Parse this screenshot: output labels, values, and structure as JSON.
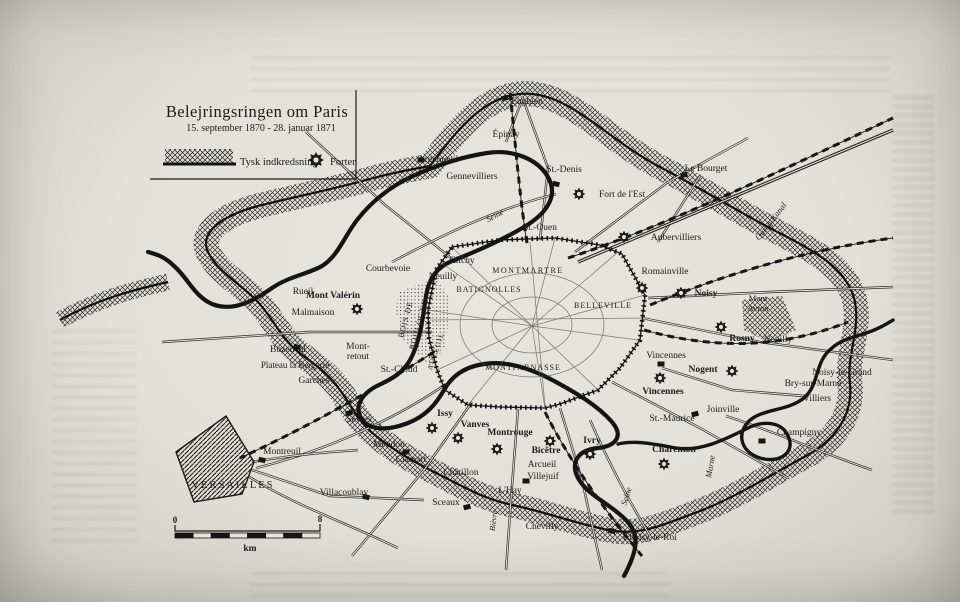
{
  "map": {
    "title": "Belejringsringen om Paris",
    "subtitle": "15. september 1870 - 28. januar 1871",
    "legend": {
      "band_label": "Tysk indkredsning",
      "fort_label": "Forter"
    },
    "scale": {
      "start": "0",
      "end": "8",
      "unit": "km"
    },
    "colors": {
      "ink": "#1b1b1b",
      "paper": "#e6e3dc",
      "page_edge": "#b7b4af"
    },
    "labels": [
      {
        "t": "Enghien",
        "x": 527,
        "y": 104
      },
      {
        "t": "Épinay",
        "x": 506,
        "y": 137
      },
      {
        "t": "Argenteuil",
        "x": 438,
        "y": 162
      },
      {
        "t": "Gennevilliers",
        "x": 472,
        "y": 179
      },
      {
        "t": "St.-Denis",
        "x": 564,
        "y": 172
      },
      {
        "t": "Le Bourget",
        "x": 706,
        "y": 171
      },
      {
        "t": "Fort de l'Est",
        "x": 622,
        "y": 197
      },
      {
        "t": "St.-Ouen",
        "x": 540,
        "y": 230
      },
      {
        "t": "Seine",
        "x": 496,
        "y": 218,
        "i": 1,
        "r": -28,
        "fs": 8.5
      },
      {
        "t": "Aubervilliers",
        "x": 676,
        "y": 240
      },
      {
        "t": "Courbevoie",
        "x": 388,
        "y": 271
      },
      {
        "t": "Clichy",
        "x": 462,
        "y": 263
      },
      {
        "t": "Neuilly",
        "x": 443,
        "y": 279
      },
      {
        "t": "MONTMARTRE",
        "x": 528,
        "y": 273,
        "fs": 8,
        "ls": 1.5
      },
      {
        "t": "BATIGNOLLES",
        "x": 489,
        "y": 292,
        "fs": 8,
        "ls": 1
      },
      {
        "t": "Romainville",
        "x": 665,
        "y": 274
      },
      {
        "t": "Noisy",
        "x": 706,
        "y": 296,
        "b": 1
      },
      {
        "t": "Mont",
        "x": 758,
        "y": 301,
        "fs": 8.5
      },
      {
        "t": "Avron",
        "x": 758,
        "y": 311,
        "fs": 8.5
      },
      {
        "t": "BELLEVILLE",
        "x": 603,
        "y": 308,
        "fs": 8,
        "ls": 1
      },
      {
        "t": "Rueil",
        "x": 303,
        "y": 294
      },
      {
        "t": "Mont Valérin",
        "x": 333,
        "y": 298,
        "b": 1
      },
      {
        "t": "Malmaison",
        "x": 313,
        "y": 315
      },
      {
        "t": "Rosny",
        "x": 742,
        "y": 341,
        "b": 1
      },
      {
        "t": "Neuilly",
        "x": 778,
        "y": 342
      },
      {
        "t": "Buzenval",
        "x": 288,
        "y": 352
      },
      {
        "t": "Mont-",
        "x": 358,
        "y": 349
      },
      {
        "t": "retout",
        "x": 358,
        "y": 359
      },
      {
        "t": "Plateau la Bergerie",
        "x": 295,
        "y": 368,
        "fs": 9
      },
      {
        "t": "Garches",
        "x": 314,
        "y": 383
      },
      {
        "t": "St.-Cloud",
        "x": 399,
        "y": 372
      },
      {
        "t": "AUTEUIL",
        "x": 438,
        "y": 352,
        "fs": 7.5,
        "r": -72,
        "ls": 1
      },
      {
        "t": "BOIS DE",
        "x": 408,
        "y": 320,
        "fs": 8,
        "r": -75,
        "ls": 1
      },
      {
        "t": "BOULOGNE",
        "x": 421,
        "y": 325,
        "fs": 8,
        "r": -75,
        "ls": 1
      },
      {
        "t": "MONTPARNASSE",
        "x": 523,
        "y": 370,
        "fs": 8,
        "ls": 1
      },
      {
        "t": "Vincennes",
        "x": 666,
        "y": 358
      },
      {
        "t": "Nogent",
        "x": 703,
        "y": 372,
        "b": 1
      },
      {
        "t": "Vincennes",
        "x": 663,
        "y": 394,
        "b": 1
      },
      {
        "t": "St.-Maurice",
        "x": 672,
        "y": 421
      },
      {
        "t": "Joinville",
        "x": 723,
        "y": 412
      },
      {
        "t": "Charenton",
        "x": 674,
        "y": 452,
        "b": 1
      },
      {
        "t": "Champigny",
        "x": 799,
        "y": 435
      },
      {
        "t": "Marne",
        "x": 713,
        "y": 467,
        "i": 1,
        "r": -80,
        "fs": 8.5
      },
      {
        "t": "Noisy-le-Grand",
        "x": 842,
        "y": 375
      },
      {
        "t": "Bry-sur-Marne",
        "x": 813,
        "y": 386
      },
      {
        "t": "Villiers",
        "x": 817,
        "y": 401
      },
      {
        "t": "Issy",
        "x": 445,
        "y": 416,
        "b": 1
      },
      {
        "t": "Vanves",
        "x": 475,
        "y": 427,
        "b": 1
      },
      {
        "t": "Montrouge",
        "x": 510,
        "y": 435,
        "b": 1
      },
      {
        "t": "Bicêtre",
        "x": 546,
        "y": 453,
        "b": 1
      },
      {
        "t": "Ivry",
        "x": 592,
        "y": 443,
        "b": 1
      },
      {
        "t": "Arcueil",
        "x": 542,
        "y": 467
      },
      {
        "t": "Villejuif",
        "x": 543,
        "y": 479
      },
      {
        "t": "Clamart",
        "x": 411,
        "y": 462
      },
      {
        "t": "Châtillon",
        "x": 461,
        "y": 475
      },
      {
        "t": "L'Hay",
        "x": 510,
        "y": 493
      },
      {
        "t": "Sceaux",
        "x": 446,
        "y": 505
      },
      {
        "t": "Chevilly",
        "x": 542,
        "y": 529
      },
      {
        "t": "Choisy-le-Roi",
        "x": 650,
        "y": 540
      },
      {
        "t": "Seine",
        "x": 629,
        "y": 497,
        "i": 1,
        "r": -72,
        "fs": 8.5
      },
      {
        "t": "Bièvre",
        "x": 496,
        "y": 521,
        "i": 1,
        "r": -83,
        "fs": 8
      },
      {
        "t": "Montreuil",
        "x": 282,
        "y": 454
      },
      {
        "t": "VERSAILLES",
        "x": 233,
        "y": 488,
        "fs": 10.5,
        "ls": 2
      },
      {
        "t": "Villacoublay",
        "x": 344,
        "y": 495
      },
      {
        "t": "Sèvres",
        "x": 359,
        "y": 422
      },
      {
        "t": "Meudon",
        "x": 389,
        "y": 447
      },
      {
        "t": "Ourcq-Kanal",
        "x": 773,
        "y": 223,
        "i": 1,
        "r": -52,
        "fs": 8.5
      }
    ],
    "forts": [
      {
        "x": 316,
        "y": 160,
        "s": 1
      },
      {
        "x": 579,
        "y": 194
      },
      {
        "x": 624,
        "y": 237
      },
      {
        "x": 642,
        "y": 288
      },
      {
        "x": 681,
        "y": 293
      },
      {
        "x": 721,
        "y": 327
      },
      {
        "x": 732,
        "y": 371
      },
      {
        "x": 660,
        "y": 378
      },
      {
        "x": 357,
        "y": 309
      },
      {
        "x": 432,
        "y": 428
      },
      {
        "x": 458,
        "y": 438
      },
      {
        "x": 497,
        "y": 449
      },
      {
        "x": 550,
        "y": 441
      },
      {
        "x": 590,
        "y": 454
      },
      {
        "x": 664,
        "y": 464
      }
    ],
    "towns": [
      {
        "x": 505,
        "y": 98
      },
      {
        "x": 421,
        "y": 160
      },
      {
        "x": 556,
        "y": 184
      },
      {
        "x": 684,
        "y": 175
      },
      {
        "x": 661,
        "y": 364
      },
      {
        "x": 262,
        "y": 460
      },
      {
        "x": 349,
        "y": 413
      },
      {
        "x": 406,
        "y": 452
      },
      {
        "x": 366,
        "y": 497
      },
      {
        "x": 467,
        "y": 507
      },
      {
        "x": 526,
        "y": 481
      },
      {
        "x": 612,
        "y": 531
      },
      {
        "x": 695,
        "y": 414
      },
      {
        "x": 762,
        "y": 441
      },
      {
        "x": 297,
        "y": 347
      }
    ]
  }
}
